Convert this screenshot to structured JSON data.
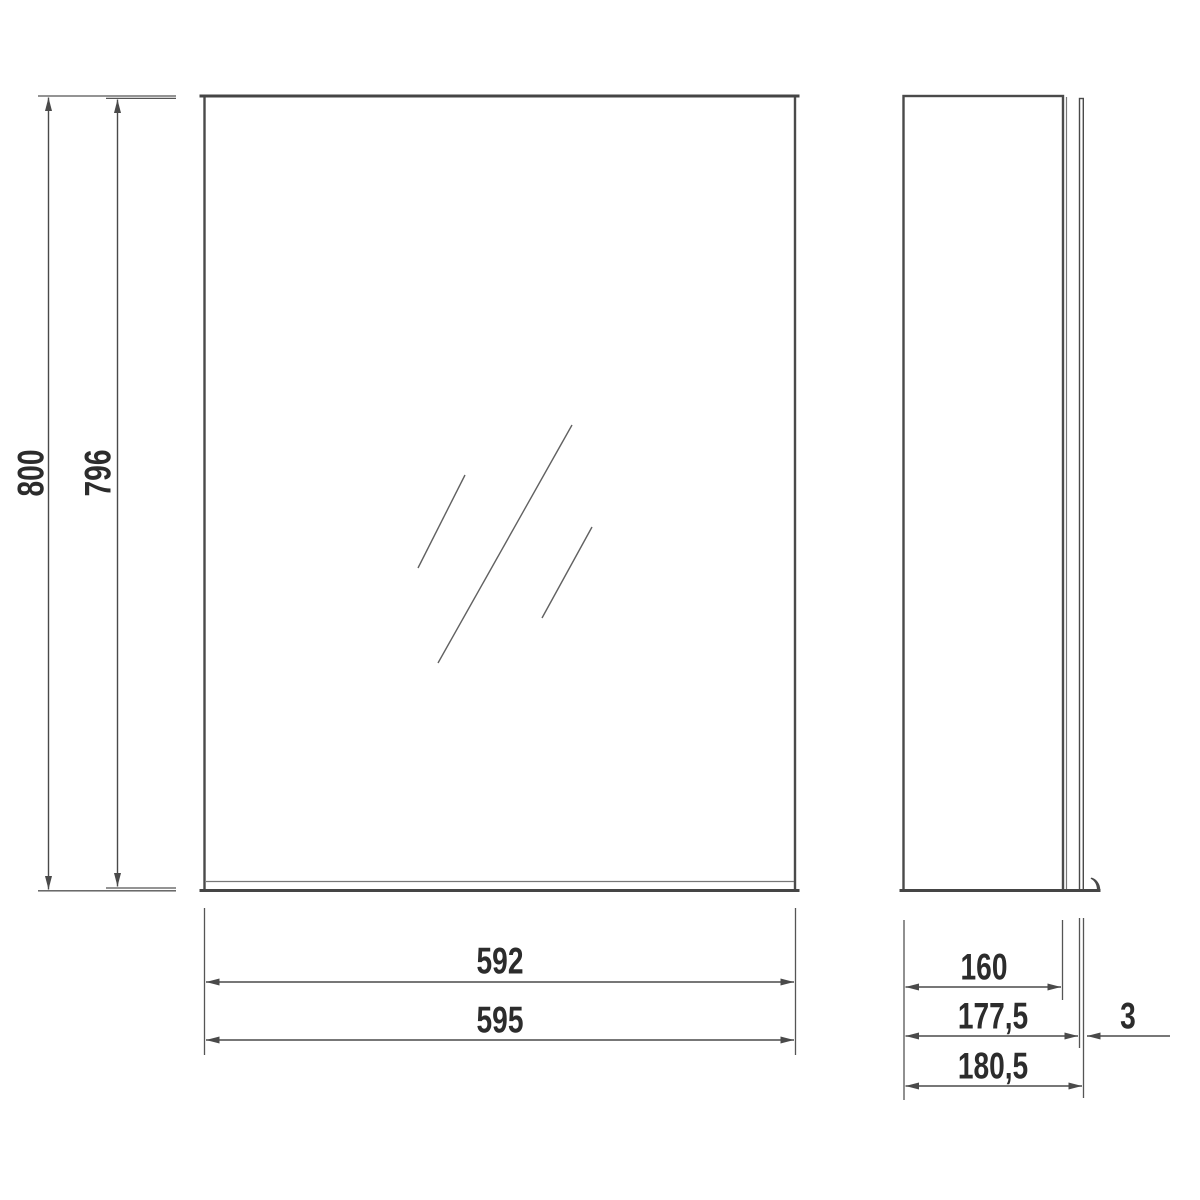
{
  "drawing": {
    "type": "technical-dimension-drawing",
    "subject": "mirror-cabinet",
    "colors": {
      "line": "#4a4a4a",
      "thin_line": "#777777",
      "text": "#2c2c2c",
      "background": "#ffffff"
    },
    "views": {
      "front": {
        "name": "front-view",
        "dimensions": {
          "overall_height": "800",
          "mirror_height": "796",
          "mirror_width": "592",
          "overall_width": "595"
        }
      },
      "side": {
        "name": "side-view",
        "dimensions": {
          "body_depth": "160",
          "depth_to_door_face": "177,5",
          "door_thickness": "3",
          "overall_depth": "180,5"
        }
      }
    }
  }
}
